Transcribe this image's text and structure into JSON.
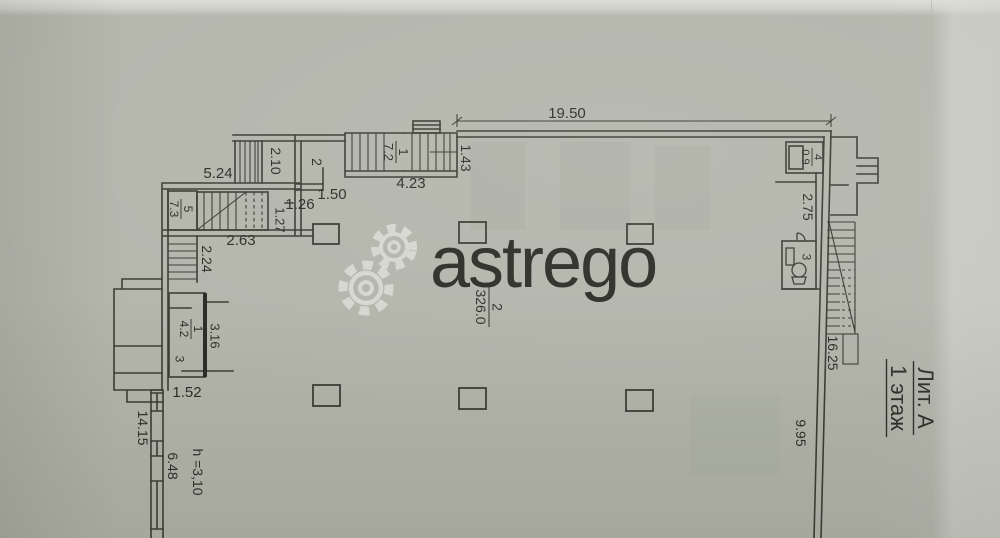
{
  "watermark": {
    "brand": "astrego"
  },
  "plan": {
    "title": {
      "line1": "Лит. А",
      "line2": "1 этаж"
    },
    "rooms": {
      "hall": {
        "number": "2",
        "area": "326.0"
      },
      "stair_room": {
        "number": "1",
        "area": "7.2"
      },
      "top_room": {
        "number": "2"
      },
      "closet": {
        "number": "4",
        "area": "0.9"
      },
      "wc": {
        "number": "3"
      },
      "room5": {
        "number": "5",
        "area": "7.3"
      },
      "left_room": {
        "number": "1",
        "area": "4.2",
        "side_mark": "3"
      }
    },
    "dims": {
      "d19_50": "19.50",
      "d2_10": "2.10",
      "d5_24": "5.24",
      "d1_50": "1.50",
      "d4_23": "4.23",
      "d1_43": "1.43",
      "d2_75": "2.75",
      "d16_25": "16.25",
      "d9_95": "9.95",
      "d2_63": "2.63",
      "d2_24": "2.24",
      "d1_26": "1.26",
      "d1_27": "1.27",
      "d3_16": "3.16",
      "d1_52": "1.52",
      "d14_15": "14.15",
      "d6_48": "6.48",
      "height": "h =3,10"
    },
    "colors": {
      "paper": "#b4b6ac",
      "ink": "#3c3c35",
      "watermark": "#ffffff"
    }
  }
}
